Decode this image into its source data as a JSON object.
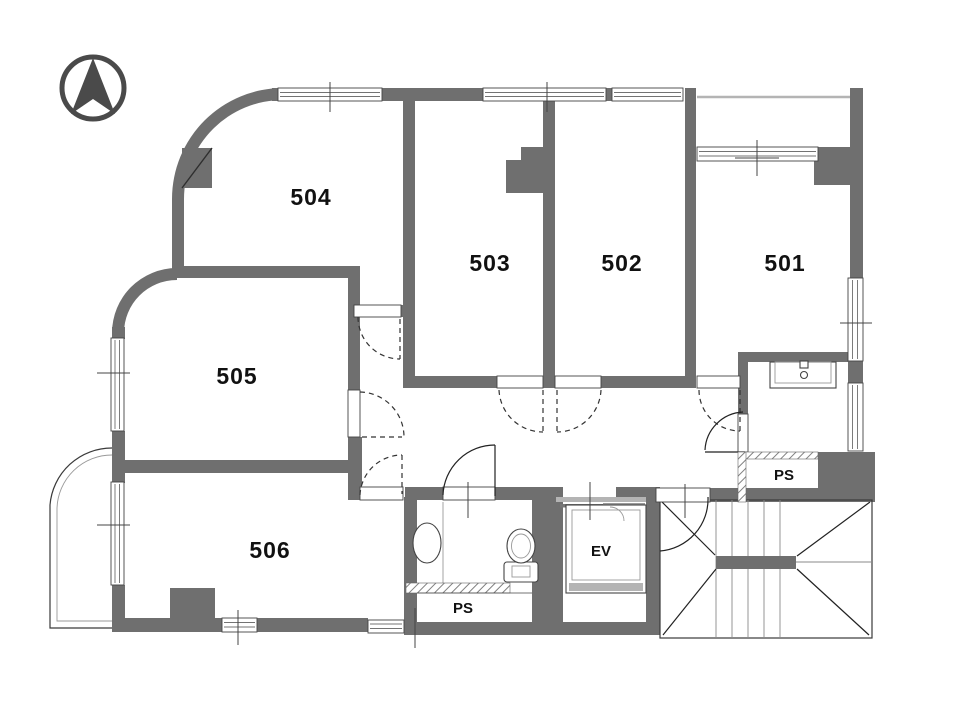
{
  "plan": {
    "title": "apartment-5th-floor-plan",
    "rooms": {
      "r501": {
        "label": "501"
      },
      "r502": {
        "label": "502"
      },
      "r503": {
        "label": "503"
      },
      "r504": {
        "label": "504"
      },
      "r505": {
        "label": "505"
      },
      "r506": {
        "label": "506"
      }
    },
    "elevator": {
      "label": "EV"
    },
    "pipe_space_bottom": {
      "label": "PS"
    },
    "pipe_space_right": {
      "label": "PS"
    },
    "icons": {
      "north_arrow": "compass-north-arrow",
      "toilet": "toilet-fixture",
      "basin": "wash-basin",
      "sink": "laundry-sink"
    },
    "colors": {
      "wall": "#6f6f6f",
      "line_dark": "#3a3a3a",
      "line_light": "#b4b4b4",
      "text": "#111111",
      "background": "#ffffff"
    }
  }
}
